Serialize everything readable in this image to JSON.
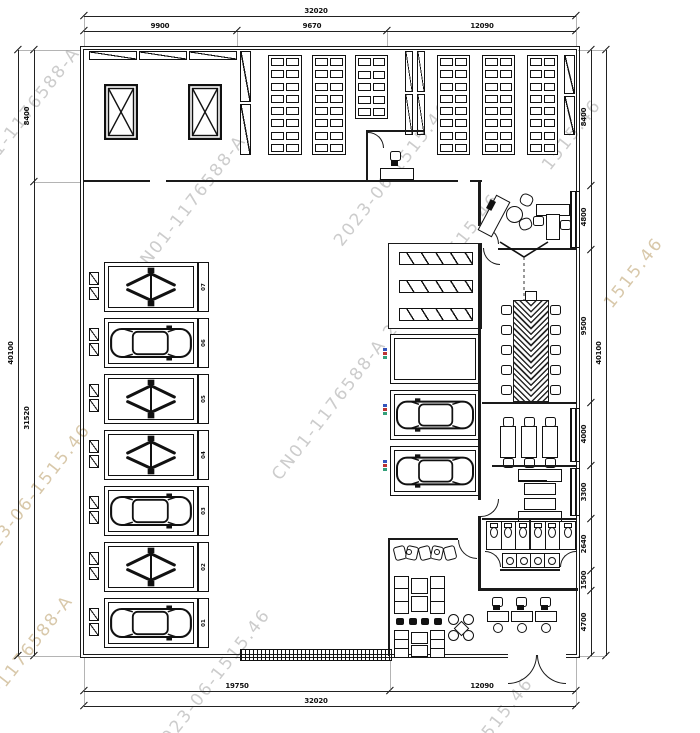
{
  "drawing": {
    "type": "floor-plan",
    "description": "Auto service workshop floor plan with lift bays, storage racks, offices, meeting room, toilets and customer reception"
  },
  "colors": {
    "line": "#1a1a1a",
    "watermark_gray": "#cccccc",
    "watermark_tan": "#d8c8aa"
  },
  "watermarks": {
    "id": "CN01-1176588-A",
    "stamp": "2023-06-1515.46",
    "full": "CN01-1176588-A  2023-06-1515.46",
    "tail": "1515.46"
  },
  "dimensions": {
    "top": {
      "overall": "32020",
      "segments": [
        "9900",
        "9670",
        "12090"
      ]
    },
    "bottom": {
      "overall": "32020",
      "segments": [
        "19750",
        "12090"
      ]
    },
    "left": {
      "overall": "40100",
      "segments": [
        "8400",
        "31520"
      ]
    },
    "right": {
      "overall": "40100",
      "segments": [
        "8400",
        "4800",
        "9500",
        "4000",
        "3300",
        "2640",
        "1500",
        "4700"
      ]
    }
  },
  "bays": [
    {
      "label": "07",
      "type": "lift"
    },
    {
      "label": "06",
      "type": "car"
    },
    {
      "label": "05",
      "type": "lift"
    },
    {
      "label": "04",
      "type": "lift"
    },
    {
      "label": "03",
      "type": "car"
    },
    {
      "label": "02",
      "type": "lift"
    },
    {
      "label": "01",
      "type": "car"
    }
  ]
}
